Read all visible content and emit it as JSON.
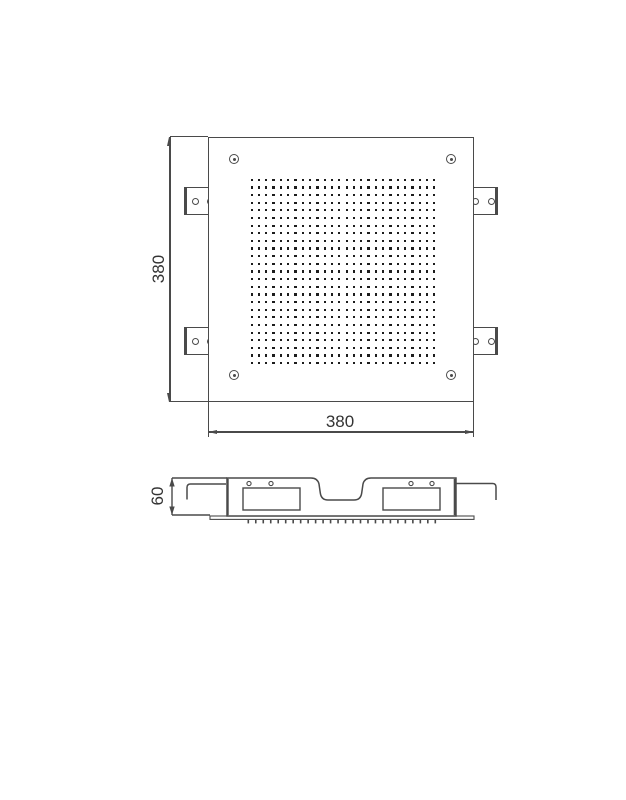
{
  "drawing": {
    "type": "technical-dimension-drawing",
    "subject": "square recessed ceiling shower head, top view and side section view",
    "colors": {
      "line": "#4a4a4a",
      "dot": "#1c1c1c",
      "text": "#333333",
      "background": "#ffffff"
    },
    "top_view": {
      "width_label": "380",
      "height_label": "380",
      "nozzle_grid": {
        "cols": 26,
        "rows": 25
      },
      "corner_screw_count": 4,
      "side_bracket_count": 4,
      "holes_per_bracket": 2
    },
    "side_view": {
      "height_label": "60",
      "nozzle_tick_count": 26,
      "window_count": 2,
      "hole_count": 4
    }
  }
}
